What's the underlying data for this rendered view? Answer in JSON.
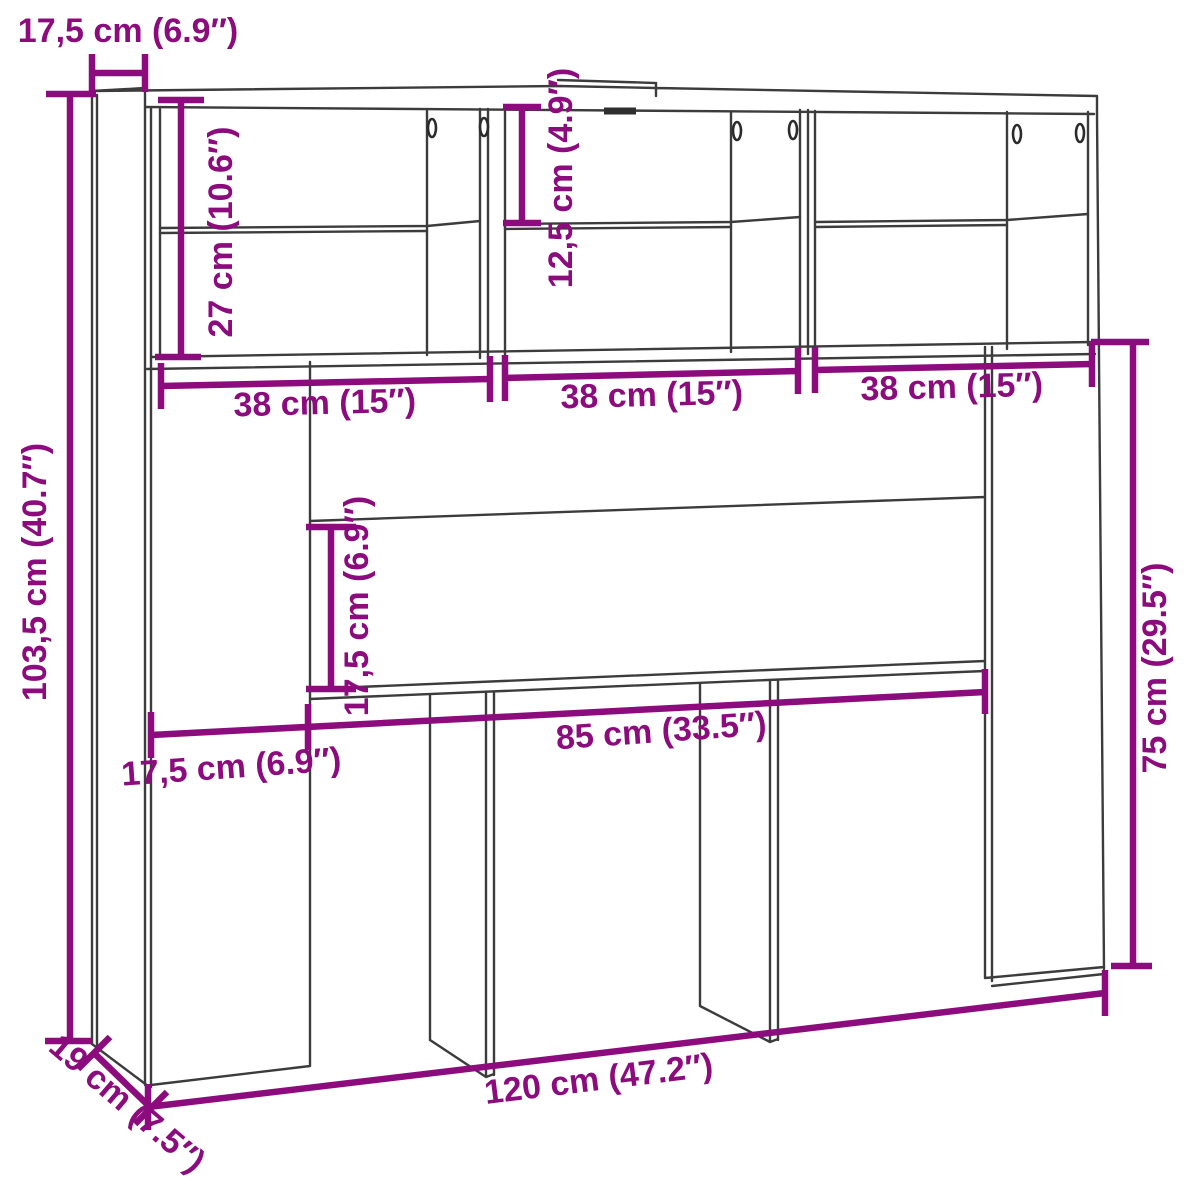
{
  "page": {
    "background": "#ffffff"
  },
  "drawing": {
    "type": "furniture-dimension-diagram",
    "subject": "headboard-storage-cabinet",
    "line_color": "#3c3c3c",
    "dimension_color": "#8c0b7d",
    "labels": {
      "top_depth": "17,5 cm (6.9″)",
      "compartment_height": "27 cm (10.6″)",
      "shelf_spacing": "12,5 cm (4.9″)",
      "compartment_width_left": "38 cm (15″)",
      "compartment_width_middle": "38 cm (15″)",
      "compartment_width_right": "38 cm (15″)",
      "total_height": "103,5 cm (40.7″)",
      "headboard_panel_height": "17,5 cm (6.9″)",
      "inner_width": "85 cm (33.5″)",
      "left_panel_width": "17,5 cm (6.9″)",
      "lower_section_height": "75 cm (29.5″)",
      "total_width": "120 cm (47.2″)",
      "base_depth": "19 cm (7.5″)"
    }
  }
}
